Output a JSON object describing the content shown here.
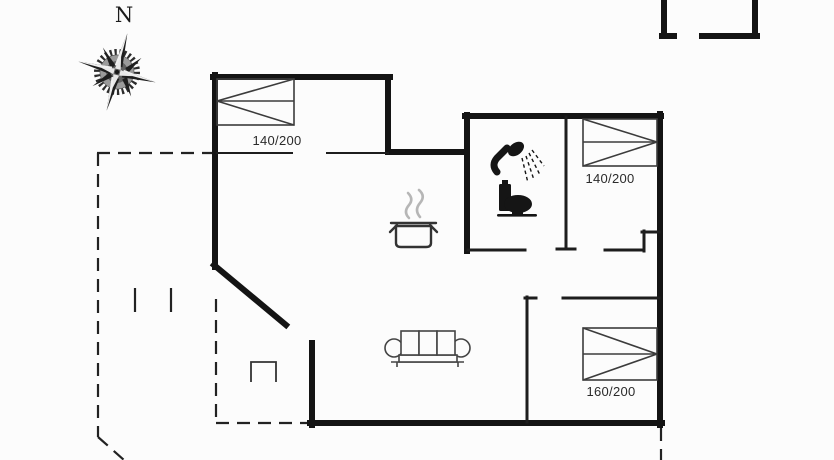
{
  "compass": {
    "north_label": "N"
  },
  "floor_plan": {
    "type": "holiday-house floor plan",
    "rooms": [
      {
        "id": "bedroom-top-left",
        "bed_size_label": "140/200"
      },
      {
        "id": "bedroom-top-right",
        "bed_size_label": "140/200"
      },
      {
        "id": "bedroom-bottom-right",
        "bed_size_label": "160/200"
      },
      {
        "id": "bathroom",
        "fixtures": [
          "shower",
          "toilet"
        ]
      },
      {
        "id": "kitchen",
        "fixtures": [
          "cooking-pot"
        ]
      },
      {
        "id": "living-room",
        "fixtures": [
          "sofa"
        ]
      }
    ],
    "outside": [
      "terrace-dashed-outline",
      "annex-partial-walls-top-right",
      "compass-rose"
    ]
  },
  "colors": {
    "background": "#fcfcfc",
    "exterior_wall": "#141414",
    "interior_wall": "#1d1d1d",
    "furniture_line": "#3c3c3c",
    "dashed_line": "#222222",
    "steam": "#b6b6b6",
    "fixture_fill": "#151515"
  }
}
